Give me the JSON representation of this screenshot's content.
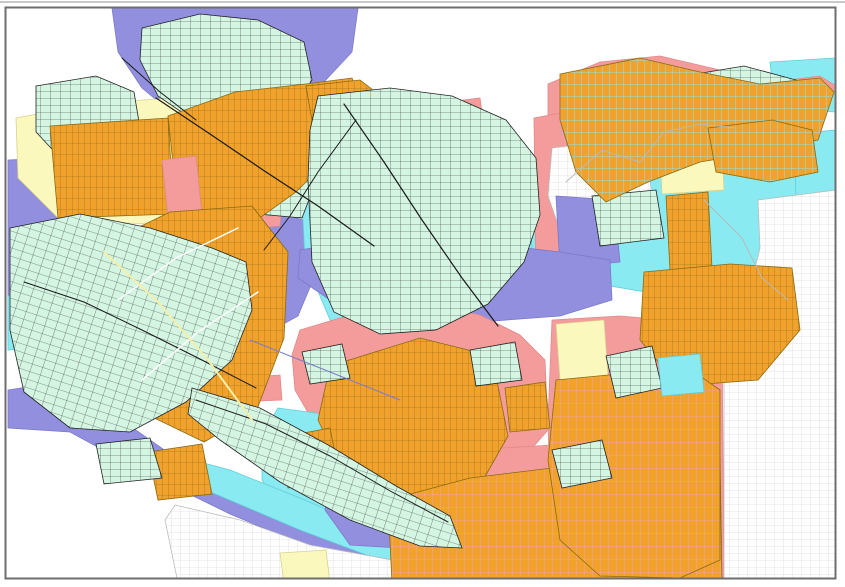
{
  "map": {
    "kind": "zoning-parcel-map",
    "width": 845,
    "height": 587,
    "palette": {
      "background": "#ffffff",
      "purple": "#918FDE",
      "cyan": "#8AEAF2",
      "pink": "#F49C9C",
      "yellow": "#FBF8BE",
      "mint": "#D3F5E2",
      "orange": "#F0A22D",
      "orange_line": "#A8761A",
      "orange_line_cyan": "#8FE2EA",
      "orange_line_pink": "#F2A3A3",
      "mint_line": "#2f2f2f",
      "gray_line": "#cccccc",
      "purple_stroke": "#7b79c9",
      "cyan_stroke": "#62cdd8",
      "pink_stroke": "#e08a8a",
      "yellow_stroke": "#d8d28e",
      "mint_stroke": "#222222",
      "orange_stroke": "#8a6a10",
      "gray_stroke": "#bbbbbb",
      "frame": "#6e6e6e",
      "frame_outer": "#c9c9c9"
    },
    "frame": {
      "x": 5.5,
      "y": 7.5,
      "w": 830,
      "h": 571,
      "stroke_width": 2,
      "outer_top_y": 1,
      "outer_top_h": 2
    },
    "regions": [
      {
        "name": "zone-purple-topleft",
        "fill": "purple",
        "stroke": "purple_stroke",
        "points": "112,8 358,8 352,52 322,84 282,108 244,124 212,132 178,118 142,88 118,52"
      },
      {
        "name": "zone-purple-left-upper",
        "fill": "purple",
        "stroke": "purple_stroke",
        "points": "8,160 52,158 88,196 96,248 70,300 34,332 8,338"
      },
      {
        "name": "zone-purple-center-west",
        "fill": "purple",
        "stroke": "purple_stroke",
        "points": "230,225 268,210 310,222 318,268 298,316 258,338 230,310 220,262"
      },
      {
        "name": "zone-purple-top-center",
        "fill": "purple",
        "stroke": "purple_stroke",
        "points": "512,160 558,150 560,200 515,205"
      },
      {
        "name": "zone-cyan-center",
        "fill": "cyan",
        "stroke": "cyan_stroke",
        "points": "312,150 380,120 450,120 520,150 548,200 545,260 505,310 450,340 390,345 330,320 305,260 302,200"
      },
      {
        "name": "zone-cyan-right-large",
        "fill": "cyan",
        "stroke": "cyan_stroke",
        "points": "528,208 560,180 596,168 640,150 700,160 724,146 770,142 812,148 836,142 836,322 786,326 730,312 670,296 610,286 560,276 532,248"
      },
      {
        "name": "zone-cyan-topright-a",
        "fill": "cyan",
        "stroke": "cyan_stroke",
        "points": "770,62 836,58 836,112 775,108"
      },
      {
        "name": "zone-cyan-topright-b",
        "fill": "cyan",
        "stroke": "cyan_stroke",
        "points": "794,134 836,130 836,200 796,198"
      },
      {
        "name": "zone-cyan-left-edge",
        "fill": "cyan",
        "stroke": "cyan_stroke",
        "points": "8,296 40,290 52,318 30,348 8,350"
      },
      {
        "name": "zone-pink-topright-band",
        "fill": "pink",
        "stroke": "pink_stroke",
        "points": "548,84 600,62 660,56 720,70 772,82 820,76 836,86 836,92 800,100 744,98 690,104 640,122 600,150 566,176 548,140"
      },
      {
        "name": "zone-pink-center-band-a",
        "fill": "pink",
        "stroke": "pink_stroke",
        "points": "534,118 566,112 570,292 536,296"
      },
      {
        "name": "zone-pink-center-patch",
        "fill": "pink",
        "stroke": "pink_stroke",
        "points": "432,104 480,98 486,142 438,148"
      },
      {
        "name": "zone-pink-center-band-b",
        "fill": "pink",
        "stroke": "pink_stroke",
        "points": "470,160 505,150 515,215 498,262 470,258 460,205"
      },
      {
        "name": "zone-pink-left-center",
        "fill": "pink",
        "stroke": "pink_stroke",
        "points": "196,196 256,192 282,202 280,226 228,230 198,222"
      },
      {
        "name": "zone-pink-left-mid",
        "fill": "pink",
        "stroke": "pink_stroke",
        "points": "232,378 280,375 282,400 236,402"
      },
      {
        "name": "zone-grayparcel-top-center",
        "fill": "pattern:gray",
        "stroke": "gray_stroke",
        "points": "552,148 600,142 648,158 652,200 640,232 600,238 560,230 548,196"
      },
      {
        "name": "zone-purple-right-mid",
        "fill": "purple",
        "stroke": "purple_stroke",
        "points": "556,196 614,200 620,262 560,268"
      },
      {
        "name": "zone-yellow-topleft",
        "fill": "yellow",
        "stroke": "yellow_stroke",
        "points": "16,118 90,104 170,98 242,108 252,158 232,214 150,224 60,220 18,178"
      },
      {
        "name": "zone-yellow-left-edge",
        "fill": "yellow",
        "stroke": "yellow_stroke",
        "points": "10,238 72,232 80,262 42,298 10,300"
      },
      {
        "name": "zone-yellow-topright",
        "fill": "yellow",
        "stroke": "yellow_stroke",
        "points": "658,108 720,104 724,190 662,194"
      },
      {
        "name": "zone-yellow-right-small",
        "fill": "yellow",
        "stroke": "yellow_stroke",
        "points": "738,288 762,286 764,312 740,314"
      },
      {
        "name": "zone-purple-central-band",
        "fill": "purple",
        "stroke": "purple_stroke",
        "points": "300,250 360,240 430,238 500,245 560,252 610,260 612,300 560,316 480,322 400,318 330,300 298,278"
      },
      {
        "name": "zone-pink-center-south",
        "fill": "pink",
        "stroke": "pink_stroke",
        "points": "300,330 360,312 430,305 480,315 520,335 545,360 548,430 520,462 470,470 420,468 360,452 318,430 295,390 292,355"
      },
      {
        "name": "zone-pink-right-south",
        "fill": "pink",
        "stroke": "pink_stroke",
        "points": "552,320 620,316 690,322 722,332 724,583 552,583 548,420"
      },
      {
        "name": "zone-pink-bottom-center",
        "fill": "pink",
        "stroke": "pink_stroke",
        "points": "390,460 470,450 552,445 552,583 395,583 385,520"
      },
      {
        "name": "zone-yellow-center-right",
        "fill": "yellow",
        "stroke": "yellow_stroke",
        "points": "556,324 604,320 608,376 560,380"
      },
      {
        "name": "zone-orange-strip-right-mid",
        "fill": "pattern:orange",
        "stroke": "orange_stroke",
        "points": "666,196 708,192 712,268 670,270"
      },
      {
        "name": "zone-mint-right-mid",
        "fill": "pattern:mint",
        "stroke": "mint_stroke",
        "points": "592,196 656,190 664,238 600,246"
      },
      {
        "name": "zone-purple-coast-band",
        "fill": "purple",
        "stroke": "purple_stroke",
        "points": "8,390 60,382 110,412 170,454 240,488 320,522 400,550 470,566 540,578 540,583 430,583 330,556 230,514 140,470 70,432 8,428"
      },
      {
        "name": "zone-cyan-bay",
        "fill": "cyan",
        "stroke": "cyan_stroke",
        "points": "278,408 330,415 338,470 330,520 290,523 262,480 262,435"
      },
      {
        "name": "zone-cyan-coast-band",
        "fill": "cyan",
        "stroke": "cyan_stroke",
        "points": "162,452 230,470 300,498 370,528 440,552 520,568 560,574 558,583 460,583 380,560 300,530 220,496 160,472"
      },
      {
        "name": "zone-grayparcel-coast",
        "fill": "pattern:gray",
        "stroke": "gray_stroke",
        "points": "175,505 240,520 310,545 420,565 430,583 178,583 165,520"
      },
      {
        "name": "zone-grayparcel-right",
        "fill": "pattern:gray",
        "stroke": "gray_stroke",
        "points": "758,200 836,190 836,583 724,583 724,336 748,296 760,248"
      },
      {
        "name": "zone-yellow-mid-small",
        "fill": "yellow",
        "stroke": "yellow_stroke",
        "points": "224,352 254,348 250,414 226,410"
      },
      {
        "name": "zone-yellow-bottom-a",
        "fill": "yellow",
        "stroke": "yellow_stroke",
        "points": "406,462 436,458 440,494 410,497"
      },
      {
        "name": "zone-yellow-bottom-b",
        "fill": "yellow",
        "stroke": "yellow_stroke",
        "points": "418,476 464,473 466,552 422,555"
      },
      {
        "name": "zone-yellow-bottom-c",
        "fill": "yellow",
        "stroke": "yellow_stroke",
        "points": "280,553 326,550 330,583 284,583"
      },
      {
        "name": "zone-mint-top-cluster",
        "fill": "pattern:mint",
        "stroke": "mint_stroke",
        "points": "142,28 200,14 258,20 304,42 312,80 292,110 246,124 196,122 158,96 140,60"
      },
      {
        "name": "zone-mint-topleft-small",
        "fill": "pattern:mint",
        "stroke": "mint_stroke",
        "points": "36,86 96,76 134,92 140,128 118,158 64,162 36,132"
      },
      {
        "name": "zone-mint-mid-small",
        "fill": "pattern:mint",
        "stroke": "mint_stroke",
        "points": "250,148 298,138 318,176 302,218 258,214 242,180"
      },
      {
        "name": "zone-mint-topright",
        "fill": "pattern:mint",
        "stroke": "mint_stroke",
        "points": "684,76 744,66 796,80 790,112 724,120 690,106"
      },
      {
        "name": "zone-mint-right-edge",
        "fill": "pattern:mint",
        "stroke": "mint_stroke",
        "points": "742,298 774,294 778,330 746,334"
      },
      {
        "name": "zone-orange-topleft-block",
        "fill": "pattern:orange",
        "stroke": "orange_stroke",
        "points": "50,126 168,118 174,214 58,218"
      },
      {
        "name": "zone-orange-topleft-band",
        "fill": "pattern:orange",
        "stroke": "orange_stroke",
        "points": "168,116 235,92 306,84 352,78 366,114 336,152 296,192 254,222 206,224 176,192"
      },
      {
        "name": "zone-pink-topleft-small",
        "fill": "pink",
        "stroke": "pink_stroke",
        "points": "162,160 196,156 202,215 168,218"
      },
      {
        "name": "zone-orange-big-west",
        "fill": "pattern:orange",
        "stroke": "orange_stroke",
        "points": "96,248 170,212 252,206 288,252 284,338 256,412 204,442 146,414 102,332"
      },
      {
        "name": "zone-orange-center-band",
        "fill": "pattern:orange",
        "stroke": "orange_stroke",
        "points": "306,86 360,80 420,126 446,196 432,258 396,244 352,184 314,132"
      },
      {
        "name": "zone-orange-topright-band",
        "fill": "pattern:orange-cyan",
        "stroke": "orange_stroke",
        "points": "560,74 640,58 700,72 760,84 820,78 834,92 818,140 760,152 700,162 648,182 606,202 576,172 560,120"
      },
      {
        "name": "zone-orange-topright-lower",
        "fill": "pattern:orange-cyan",
        "stroke": "orange_stroke",
        "points": "708,128 772,120 812,130 818,172 770,182 716,172"
      },
      {
        "name": "zone-orange-right-center",
        "fill": "pattern:orange",
        "stroke": "orange_stroke",
        "points": "644,272 730,264 792,268 800,330 758,380 678,386 640,340"
      },
      {
        "name": "zone-orange-center-small",
        "fill": "pattern:orange",
        "stroke": "orange_stroke",
        "points": "430,258 470,250 480,300 438,306"
      },
      {
        "name": "zone-mint-big-west",
        "fill": "pattern:mint-rot",
        "stroke": "mint_stroke",
        "points": "10,228 80,214 150,228 212,248 246,262 252,310 232,360 186,402 130,432 70,428 24,392 10,330"
      },
      {
        "name": "zone-mint-big-center",
        "fill": "pattern:mint",
        "stroke": "mint_stroke",
        "points": "318,96 390,88 452,96 506,120 536,158 540,215 524,262 488,304 436,330 380,334 334,312 312,262 308,180 310,130"
      },
      {
        "name": "zone-purple-bottom-blob",
        "fill": "purple",
        "stroke": "purple_stroke",
        "points": "332,465 395,458 425,470 428,520 400,548 350,545 325,510"
      },
      {
        "name": "zone-purple-bottom-sliver",
        "fill": "purple",
        "stroke": "purple_stroke",
        "points": "552,568 575,566 578,580 554,581"
      },
      {
        "name": "zone-orange-center-south",
        "fill": "pattern:orange",
        "stroke": "orange_stroke",
        "points": "330,366 420,338 492,356 508,436 474,496 404,506 342,470 318,420"
      },
      {
        "name": "zone-orange-small-a",
        "fill": "pattern:orange",
        "stroke": "orange_stroke",
        "points": "505,388 545,382 550,428 510,432"
      },
      {
        "name": "zone-orange-small-b",
        "fill": "pattern:orange",
        "stroke": "orange_stroke",
        "points": "278,438 330,428 340,478 288,488"
      },
      {
        "name": "zone-orange-small-c",
        "fill": "pattern:orange",
        "stroke": "orange_stroke",
        "points": "148,452 202,444 212,494 158,500"
      },
      {
        "name": "zone-orange-bottom-grid",
        "fill": "pattern:orange-pink",
        "stroke": "orange_stroke",
        "points": "388,500 470,478 552,468 640,466 720,458 722,583 392,583"
      },
      {
        "name": "zone-orange-bottomright-grid",
        "fill": "pattern:orange-pink",
        "stroke": "orange_stroke",
        "points": "556,380 640,372 700,376 720,390 720,560 680,578 600,576 560,540 548,460"
      },
      {
        "name": "zone-mint-coast-strip",
        "fill": "pattern:mint-rot",
        "stroke": "mint_stroke",
        "points": "192,388 260,408 330,446 396,486 450,516 462,548 420,546 350,520 280,482 220,440 188,414"
      },
      {
        "name": "zone-mint-small-a",
        "fill": "pattern:mint",
        "stroke": "mint_stroke",
        "points": "606,356 652,346 662,388 616,398"
      },
      {
        "name": "zone-mint-small-b",
        "fill": "pattern:mint",
        "stroke": "mint_stroke",
        "points": "552,450 602,440 612,478 562,488"
      },
      {
        "name": "zone-mint-small-c",
        "fill": "pattern:mint",
        "stroke": "mint_stroke",
        "points": "302,352 342,344 350,378 310,384"
      },
      {
        "name": "zone-mint-small-d",
        "fill": "pattern:mint",
        "stroke": "mint_stroke",
        "points": "470,350 515,342 522,380 476,386"
      },
      {
        "name": "zone-mint-small-e",
        "fill": "pattern:mint",
        "stroke": "mint_stroke",
        "points": "96,444 150,438 162,478 104,484"
      },
      {
        "name": "zone-cyan-small-right",
        "fill": "cyan",
        "stroke": "cyan_stroke",
        "points": "658,358 700,354 704,392 662,396"
      }
    ],
    "roads": [
      {
        "name": "road-topleft-main",
        "stroke": "#1a1a1a",
        "width": 1.2,
        "points": "156,98 210,134 266,172 318,206 374,246"
      },
      {
        "name": "road-topleft-short",
        "stroke": "#1a1a1a",
        "width": 1,
        "points": "122,58 160,92 196,120"
      },
      {
        "name": "road-center-main",
        "stroke": "#1a1a1a",
        "width": 1.2,
        "points": "344,104 384,162 422,220 462,278 498,326"
      },
      {
        "name": "road-center-west",
        "stroke": "#1a1a1a",
        "width": 1,
        "points": "356,120 318,172 290,216 264,250"
      },
      {
        "name": "road-left-cluster",
        "stroke": "#1a1a1a",
        "width": 1,
        "points": "24,282 84,302 142,330 198,358 256,388"
      },
      {
        "name": "road-coast",
        "stroke": "#222222",
        "width": 1,
        "points": "196,400 266,424 330,456 392,492 448,522"
      },
      {
        "name": "street-orange-west-a",
        "stroke": "#ffffff",
        "width": 1.5,
        "points": "118,300 176,258 238,228"
      },
      {
        "name": "street-orange-west-b",
        "stroke": "#ffffff",
        "width": 1.5,
        "points": "142,380 198,332 258,292"
      },
      {
        "name": "street-orange-west-yellow",
        "stroke": "#F5EFA8",
        "width": 2,
        "points": "104,252 158,302 208,360 252,420"
      },
      {
        "name": "boundary-cyan-a",
        "stroke": "#b9b9b9",
        "width": 1,
        "points": "566,182 602,150 640,162 664,132 700,124 736,128"
      },
      {
        "name": "boundary-cyan-b",
        "stroke": "#b9b9b9",
        "width": 1,
        "points": "704,200 742,238 762,278 788,300"
      },
      {
        "name": "stream-purple",
        "stroke": "#7d7bcb",
        "width": 1,
        "points": "250,340 300,360 350,380 400,400"
      }
    ]
  }
}
